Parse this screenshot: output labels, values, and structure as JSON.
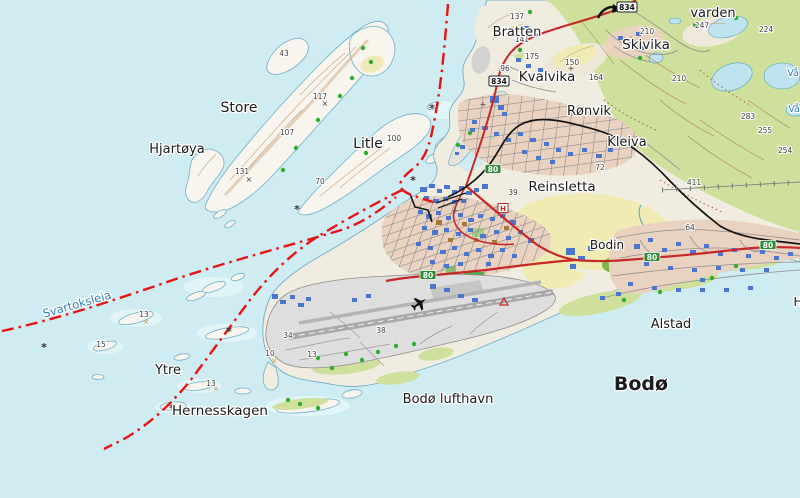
{
  "map": {
    "colors": {
      "sea": "#cfecf3",
      "shallow": "#e3f6f8",
      "land_base": "#f1ece0",
      "island": "#f8f5ee",
      "forest": "#cfe09c",
      "forest_dark": "#7fb449",
      "field_yellow": "#f0ebb2",
      "urban": "#e9d2c0",
      "airport_gray": "#dedede",
      "runway": "#a9a9a9",
      "road_red": "#c62828",
      "road_minor": "#8f8f8f",
      "railway": "#141414",
      "ferry_red": "#e81414",
      "building_blue": "#4a76cf",
      "building_brown": "#a97637",
      "lake": "#bfe3ef",
      "coast": "#6fb0c9",
      "contour_tan": "#c9a176",
      "contour_brown": "#a9824f",
      "label": "#1c1c1c",
      "water_label": "#2f7fc1",
      "green_dot": "#2fae2f",
      "shield_green": "#2f8b34",
      "shield_white": "#ffffff"
    },
    "place_labels": [
      {
        "text": "Store",
        "x": 239,
        "y": 112,
        "size": 14
      },
      {
        "text": "Hjartøya",
        "x": 177,
        "y": 153,
        "size": 13
      },
      {
        "text": "Litle",
        "x": 368,
        "y": 148,
        "size": 14
      },
      {
        "text": "Bratten",
        "x": 517,
        "y": 36,
        "size": 13
      },
      {
        "text": "Skivika",
        "x": 646,
        "y": 49,
        "size": 13.5
      },
      {
        "text": "Kvalvika",
        "x": 547,
        "y": 81,
        "size": 13.5
      },
      {
        "text": "Rønvik",
        "x": 589,
        "y": 115,
        "size": 13
      },
      {
        "text": "Kleiva",
        "x": 627,
        "y": 146,
        "size": 13
      },
      {
        "text": "Reinsletta",
        "x": 562,
        "y": 191,
        "size": 13.5
      },
      {
        "text": "Bodin",
        "x": 607,
        "y": 249,
        "size": 12
      },
      {
        "text": "varden",
        "x": 713,
        "y": 17,
        "size": 13
      },
      {
        "text": "Alstad",
        "x": 671,
        "y": 328,
        "size": 13
      },
      {
        "text": "Bodø",
        "x": 641,
        "y": 390,
        "size": 19,
        "bold": true
      },
      {
        "text": "Bodø lufthavn",
        "x": 448,
        "y": 403,
        "size": 13
      },
      {
        "text": "Ytre",
        "x": 168,
        "y": 374,
        "size": 13
      },
      {
        "text": "Hernesskagen",
        "x": 220,
        "y": 415,
        "size": 13.5
      },
      {
        "text": "Svartoksleia",
        "x": 78,
        "y": 308,
        "size": 11.5,
        "color": "#2f7fc1",
        "rotate": -16
      },
      {
        "text": "Vå",
        "x": 793,
        "y": 76,
        "size": 9.5,
        "color": "#2f7fc1"
      },
      {
        "text": "Vå",
        "x": 794,
        "y": 112,
        "size": 9.5,
        "color": "#2f7fc1"
      },
      {
        "text": "H",
        "x": 798,
        "y": 306,
        "size": 12
      }
    ],
    "elevation_labels": [
      {
        "t": "43",
        "x": 284,
        "y": 56
      },
      {
        "t": "117",
        "x": 320,
        "y": 99
      },
      {
        "t": "107",
        "x": 287,
        "y": 135
      },
      {
        "t": "131",
        "x": 242,
        "y": 174
      },
      {
        "t": "70",
        "x": 320,
        "y": 184
      },
      {
        "t": "100",
        "x": 394,
        "y": 141
      },
      {
        "t": "137",
        "x": 517,
        "y": 19
      },
      {
        "t": "141",
        "x": 522,
        "y": 42
      },
      {
        "t": "175",
        "x": 532,
        "y": 59
      },
      {
        "t": "96",
        "x": 505,
        "y": 71
      },
      {
        "t": "150",
        "x": 572,
        "y": 65
      },
      {
        "t": "164",
        "x": 596,
        "y": 80
      },
      {
        "t": "210",
        "x": 647,
        "y": 34
      },
      {
        "t": "247",
        "x": 702,
        "y": 28
      },
      {
        "t": "224",
        "x": 766,
        "y": 32
      },
      {
        "t": "210",
        "x": 679,
        "y": 81
      },
      {
        "t": "283",
        "x": 748,
        "y": 119
      },
      {
        "t": "255",
        "x": 765,
        "y": 133
      },
      {
        "t": "254",
        "x": 785,
        "y": 153
      },
      {
        "t": "411",
        "x": 694,
        "y": 185
      },
      {
        "t": "72",
        "x": 600,
        "y": 170
      },
      {
        "t": "64",
        "x": 690,
        "y": 230
      },
      {
        "t": "39",
        "x": 513,
        "y": 195
      },
      {
        "t": "38",
        "x": 381,
        "y": 333
      },
      {
        "t": "34",
        "x": 288,
        "y": 338
      },
      {
        "t": "13",
        "x": 144,
        "y": 317
      },
      {
        "t": "15",
        "x": 101,
        "y": 347
      },
      {
        "t": "13",
        "x": 211,
        "y": 386
      },
      {
        "t": "13",
        "x": 312,
        "y": 357
      },
      {
        "t": "10",
        "x": 270,
        "y": 356
      }
    ],
    "road_shields": [
      {
        "num": "80",
        "x": 493,
        "y": 169,
        "style": "green"
      },
      {
        "num": "80",
        "x": 428,
        "y": 275,
        "style": "green"
      },
      {
        "num": "80",
        "x": 652,
        "y": 257,
        "style": "green"
      },
      {
        "num": "80",
        "x": 768,
        "y": 245,
        "style": "green"
      },
      {
        "num": "834",
        "x": 499,
        "y": 81,
        "style": "white"
      },
      {
        "num": "834",
        "x": 627,
        "y": 7,
        "style": "white"
      }
    ],
    "icons": {
      "hospital": "H",
      "anchorage": "*",
      "church_cross": "+",
      "rock_cross": "x"
    }
  }
}
